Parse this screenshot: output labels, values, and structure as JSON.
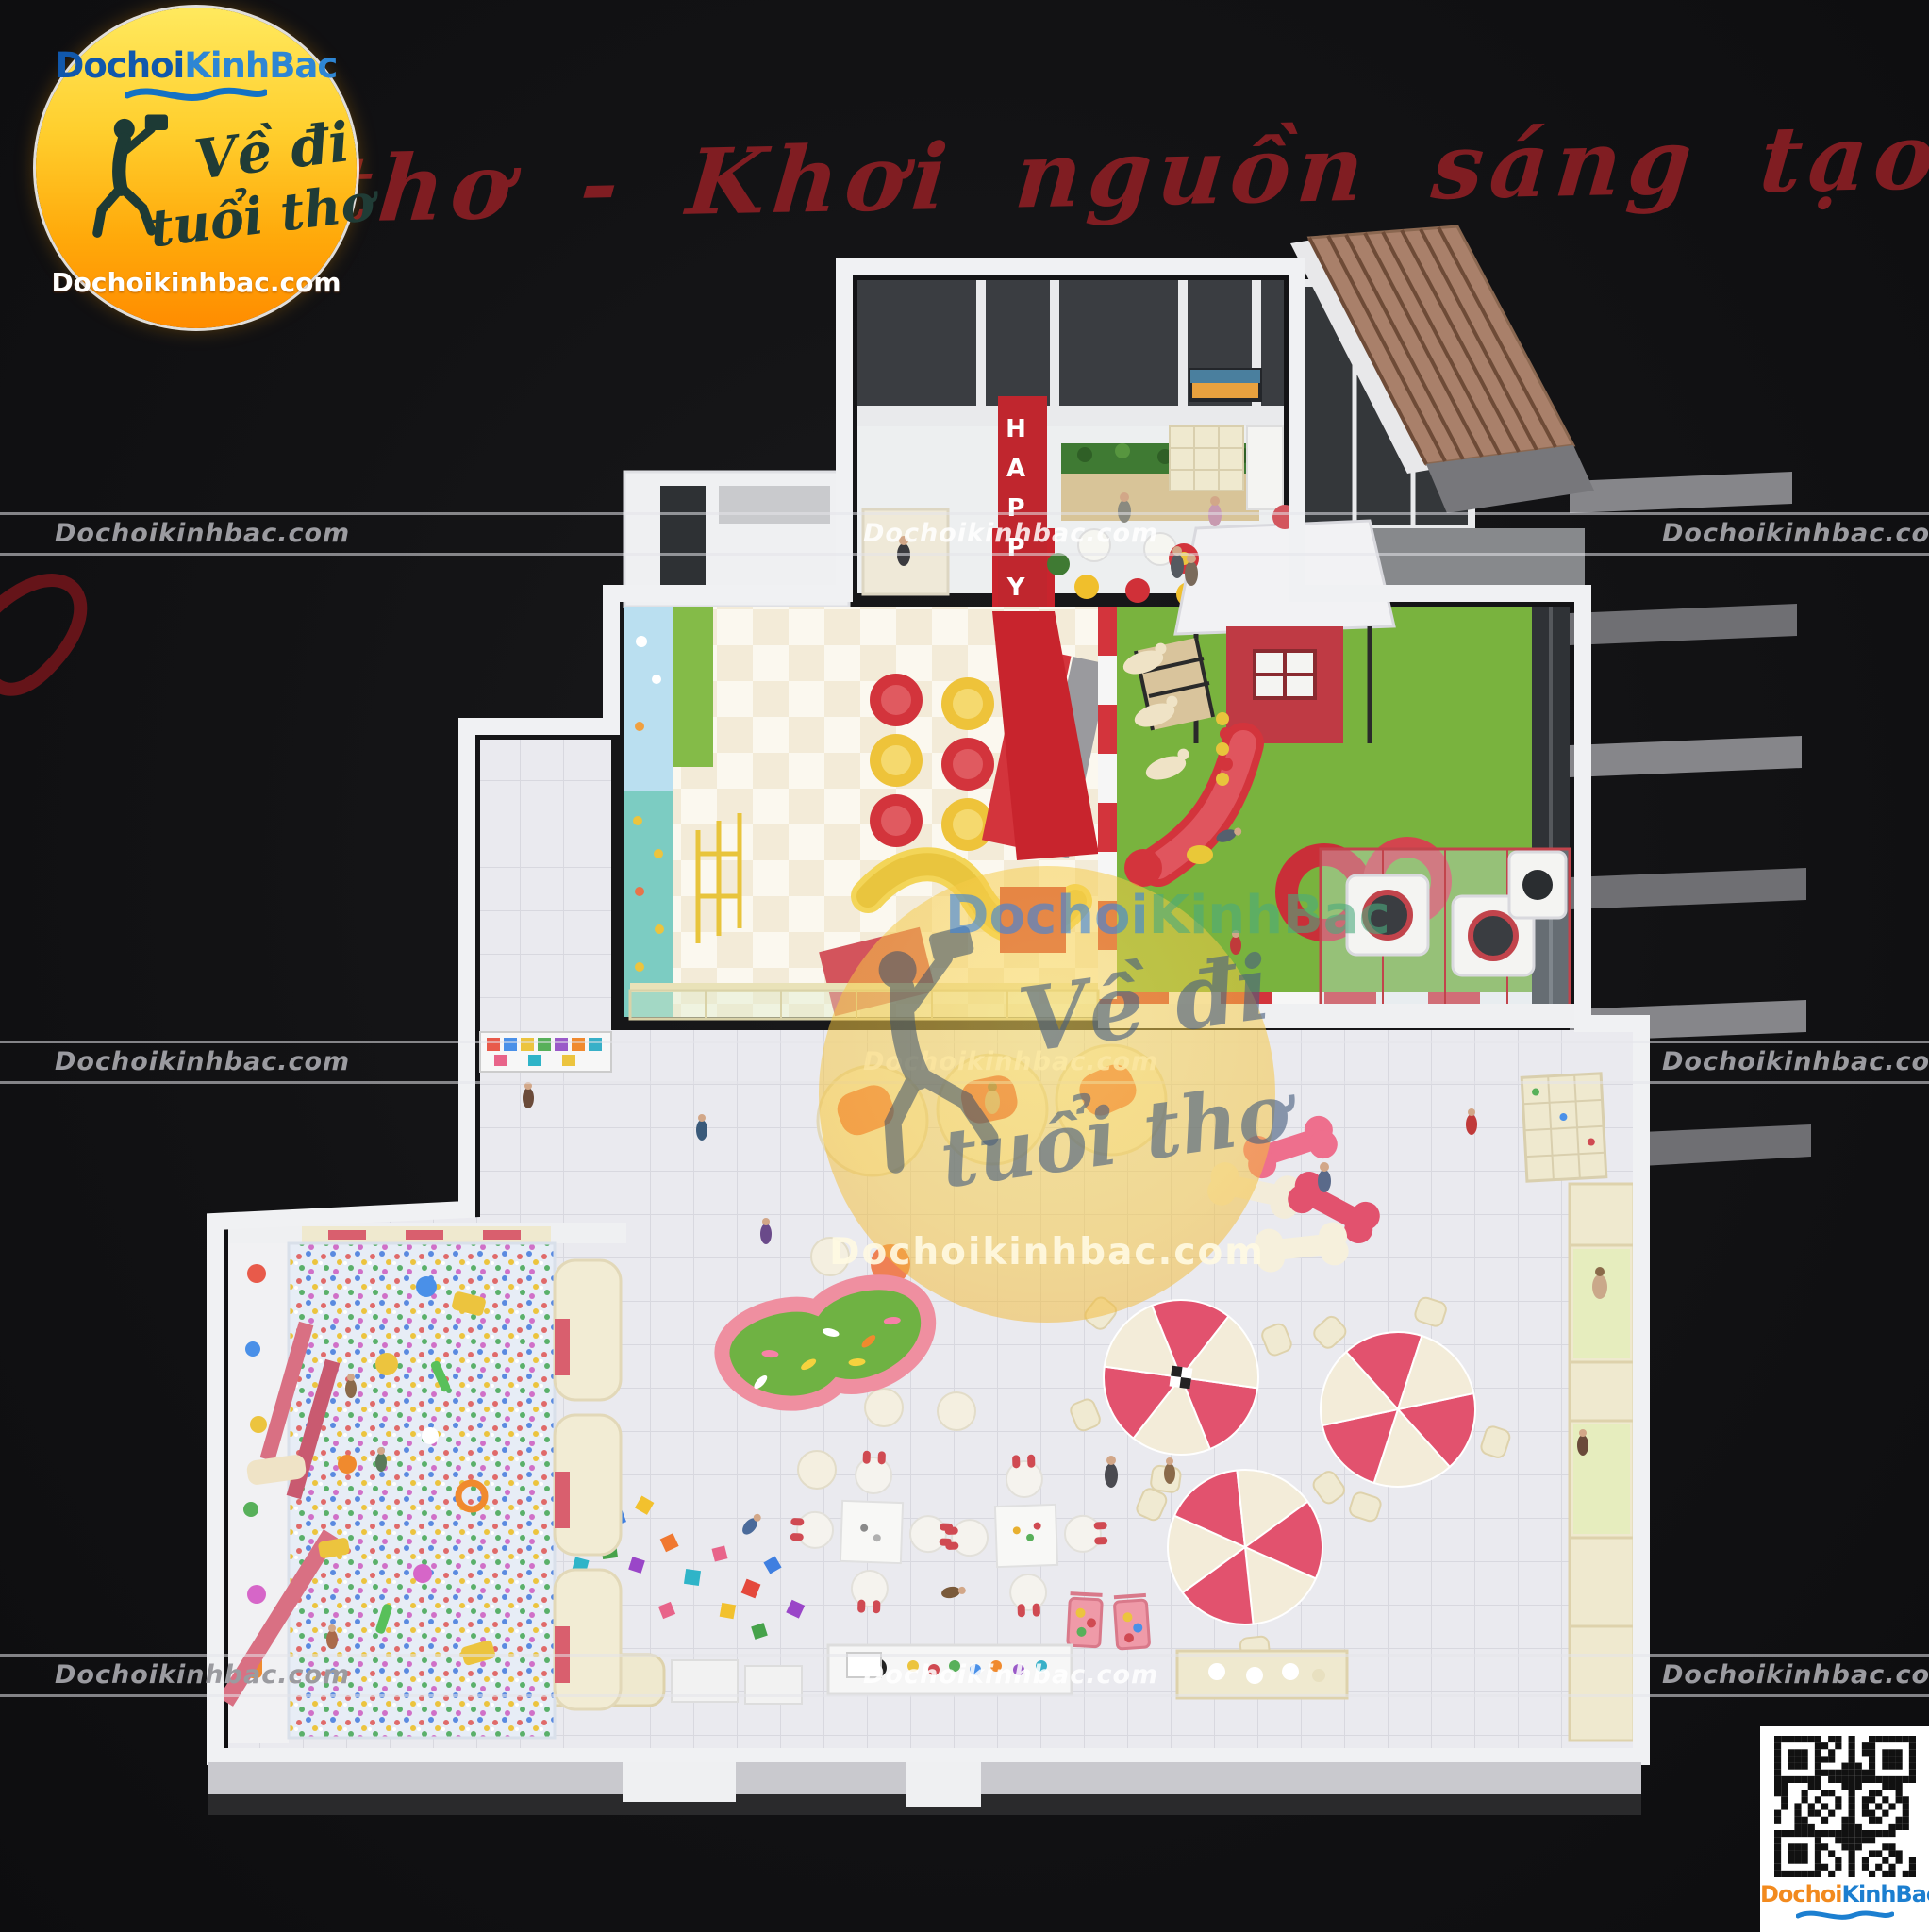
{
  "brand": {
    "dochoi": "Dochoi",
    "kinhbac": "KinhBac",
    "website": "Dochoikinhbac.com"
  },
  "logo_badge": {
    "script_line1": "Về đi",
    "script_line2": "tuổi thơ",
    "website": "Dochoikinhbac.com"
  },
  "top_slogan": {
    "visible_text": "i thơ - Khơi nguồn sáng tạo"
  },
  "watermark_bands": {
    "url_text": "Dochoikinhbac.com"
  },
  "center_watermark": {
    "script_line1": "Về đi",
    "script_line2": "tuổi thơ",
    "website": "Dochoikinhbac.com",
    "brand_dochoi": "Dochoi",
    "brand_kinhbac": "KinhBac"
  },
  "entrance": {
    "happy_sign": "HAPPY"
  },
  "qr_card": {
    "brand_dochoi": "Dochoi",
    "brand_kinhbac": "KinhBac"
  },
  "colors": {
    "background": "#121214",
    "logo_yellow": "#ffe95e",
    "logo_orange": "#ff8c00",
    "brand_blue_dark": "#1158ac",
    "brand_blue_light": "#2e86d4",
    "qr_orange": "#f28a1e",
    "qr_blue": "#1c7fd0",
    "slogan_red": "#8a1e24",
    "accent_red": "#c8242d",
    "grass_green": "#79b33e",
    "pink": "#e2526e",
    "cream": "#efe9cf",
    "teal_wall": "#7ccfc4",
    "watermark_yellow": "rgba(247,206,74,0.5)"
  }
}
